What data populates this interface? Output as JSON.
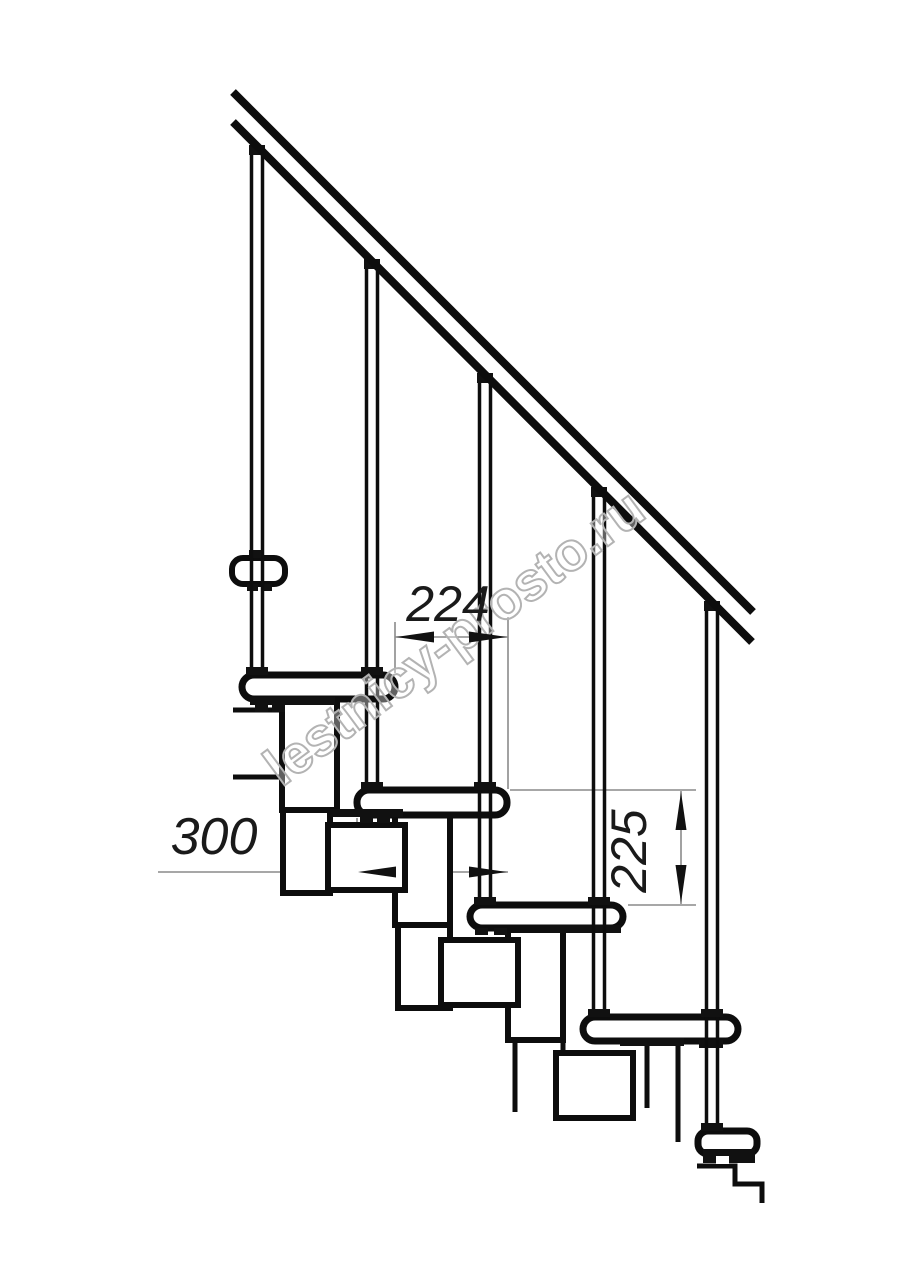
{
  "page": {
    "type": "technical-drawing",
    "subject": "modular staircase side view",
    "background": "#ffffff"
  },
  "watermark": {
    "text": "lestnicy-prosto.ru",
    "stroke_color": "#b3b3b3",
    "fill_color": "rgba(255,255,255,0.35)"
  },
  "dimensions": {
    "step_run": {
      "label": "224",
      "orientation": "horizontal"
    },
    "tread_depth": {
      "label": "300",
      "orientation": "horizontal"
    },
    "riser_height": {
      "label": "225",
      "orientation": "vertical"
    }
  },
  "structure": {
    "baluster_count": "5",
    "tread_count": "5"
  },
  "colors": {
    "line": "#0d0d0d",
    "dim_line": "#8a8a8a",
    "arrow": "#111111",
    "text": "#1a1a1a",
    "background": "#ffffff"
  }
}
